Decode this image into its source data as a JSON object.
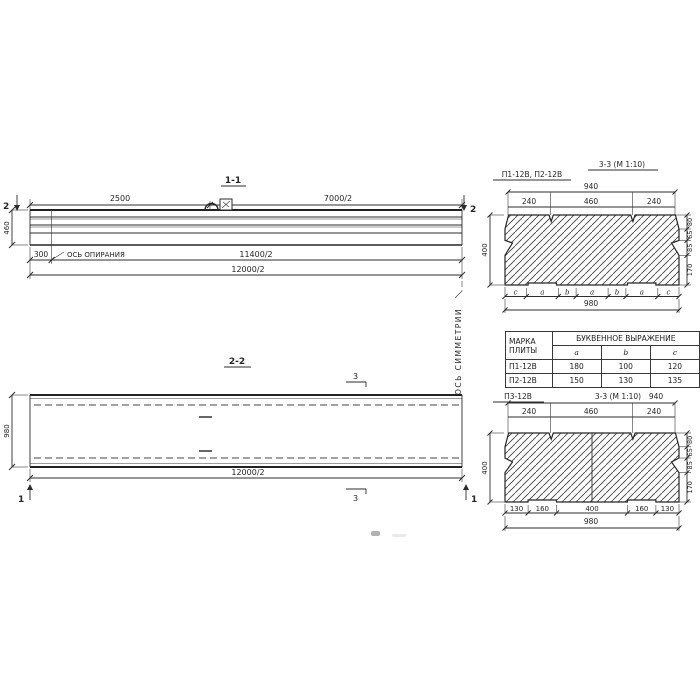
{
  "v11": {
    "title": "1-1",
    "dim_2500": "2500",
    "dim_7000": "7000/2",
    "height": "460",
    "dim_300": "300",
    "support_axis": "ОСЬ ОПИРАНИЯ",
    "dim_11400": "11400/2",
    "dim_12000": "12000/2",
    "cut": "2"
  },
  "v22": {
    "title": "2-2",
    "width": "980",
    "dim_12000": "12000/2",
    "cut3": "3",
    "cut1": "1"
  },
  "sym": "ОСЬ СИММЕТРИИ",
  "s_top": {
    "label": "П1-12В, П2-12В",
    "title": "3-3 (М 1:10)",
    "d940": "940",
    "d240a": "240",
    "d460": "460",
    "d240b": "240",
    "h": "400",
    "r1": "80",
    "r2": "65",
    "r3": "85",
    "r4": "170",
    "L": [
      "c",
      "a",
      "b",
      "a",
      "b",
      "a",
      "c"
    ],
    "d980": "980"
  },
  "tbl": {
    "h_mark1": "МАРКА",
    "h_mark2": "ПЛИТЫ",
    "h_group": "БУКВЕННОЕ ВЫРАЖЕНИЕ",
    "cols": [
      "a",
      "b",
      "c"
    ],
    "rows": [
      [
        "П1-12В",
        "180",
        "100",
        "120"
      ],
      [
        "П2-12В",
        "150",
        "130",
        "135"
      ]
    ]
  },
  "s_bot": {
    "label": "П3-12В",
    "title": "3-3 (М 1:10)",
    "d940": "940",
    "d240a": "240",
    "d460": "460",
    "d240b": "240",
    "h": "400",
    "r1": "80",
    "r2": "65",
    "r3": "85",
    "r4": "170",
    "b1": "130",
    "b2": "160",
    "b3": "400",
    "b4": "160",
    "b5": "130",
    "d980": "980"
  }
}
